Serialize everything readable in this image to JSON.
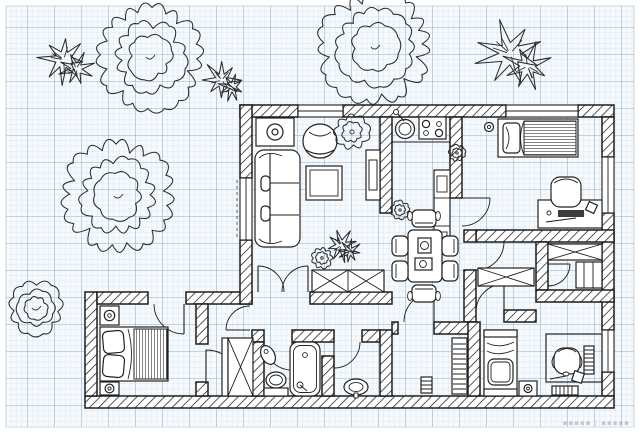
{
  "meta": {
    "description": "Black-ink apartment floor plan drawn over blue graph paper, with garden trees and shrubs outside the walls",
    "canvas_width": 640,
    "canvas_height": 433
  },
  "colors": {
    "paper_margin": "#ffffff",
    "grid_background": "#f6fafd",
    "grid_minor_line": "#d9e7f2",
    "grid_major_line": "#8cadce",
    "ink": "#1d1d1d",
    "watermark_gray": "#98a2ac"
  },
  "watermark": {
    "text": "▪▪▪▪▪ / ▪▪▪▪▪"
  },
  "floor_plan": {
    "window_count": 5,
    "door_count": 12,
    "rooms": [
      {
        "id": "living-room",
        "furniture": [
          "sofa",
          "armchair",
          "coffee-table",
          "side-table-with-lamp",
          "tv-cabinet",
          "potted-plant"
        ]
      },
      {
        "id": "kitchen",
        "furniture": [
          "round-sink",
          "cooktop-4-burner",
          "tall-cabinet",
          "small-plant"
        ]
      },
      {
        "id": "bedroom-top-right",
        "furniture": [
          "single-bed",
          "desk",
          "office-chair",
          "ceiling-lamp",
          "keyboard",
          "mouse"
        ]
      },
      {
        "id": "closet-room-left",
        "furniture": [
          "wardrobe-x"
        ]
      },
      {
        "id": "closet-room-right",
        "furniture": [
          "wardrobe-x",
          "shelf-cabinet"
        ]
      },
      {
        "id": "dining-area",
        "furniture": [
          "dining-table",
          "six-chairs",
          "tableware"
        ]
      },
      {
        "id": "hallway",
        "furniture": [
          "double-entry-door",
          "shoe-cabinet-x",
          "potted-plants"
        ]
      },
      {
        "id": "bedroom-bottom-left",
        "furniture": [
          "double-bed",
          "nightstand-with-lamp",
          "nightstand-with-lamp"
        ]
      },
      {
        "id": "walk-in-closet",
        "furniture": [
          "wardrobe-x",
          "rail"
        ]
      },
      {
        "id": "bathroom",
        "furniture": [
          "bathtub",
          "toilet",
          "wall-basin"
        ]
      },
      {
        "id": "washroom",
        "furniture": [
          "washbasin"
        ]
      },
      {
        "id": "corridor",
        "furniture": [
          "radiator",
          "floor-mat"
        ]
      },
      {
        "id": "bedroom-bottom-right",
        "furniture": [
          "single-bed",
          "desk",
          "office-chair",
          "stool",
          "book-stack",
          "book-rack"
        ]
      }
    ],
    "vegetation": {
      "cloud_trees": [
        {
          "x": 150,
          "y": 57,
          "r": 47
        },
        {
          "x": 375,
          "y": 47,
          "r": 50
        },
        {
          "x": 118,
          "y": 196,
          "r": 50
        },
        {
          "x": 36,
          "y": 308,
          "r": 25
        }
      ],
      "leaf_plants": [
        {
          "x": 68,
          "y": 62,
          "r": 24
        },
        {
          "x": 225,
          "y": 82,
          "r": 19
        },
        {
          "x": 516,
          "y": 57,
          "r": 33
        },
        {
          "x": 344,
          "y": 247,
          "r": 16
        }
      ],
      "flower_plants": [
        {
          "x": 352,
          "y": 132,
          "r": 15
        },
        {
          "x": 322,
          "y": 258,
          "r": 9
        },
        {
          "x": 457,
          "y": 153,
          "r": 7
        },
        {
          "x": 400,
          "y": 210,
          "r": 8
        }
      ]
    }
  }
}
